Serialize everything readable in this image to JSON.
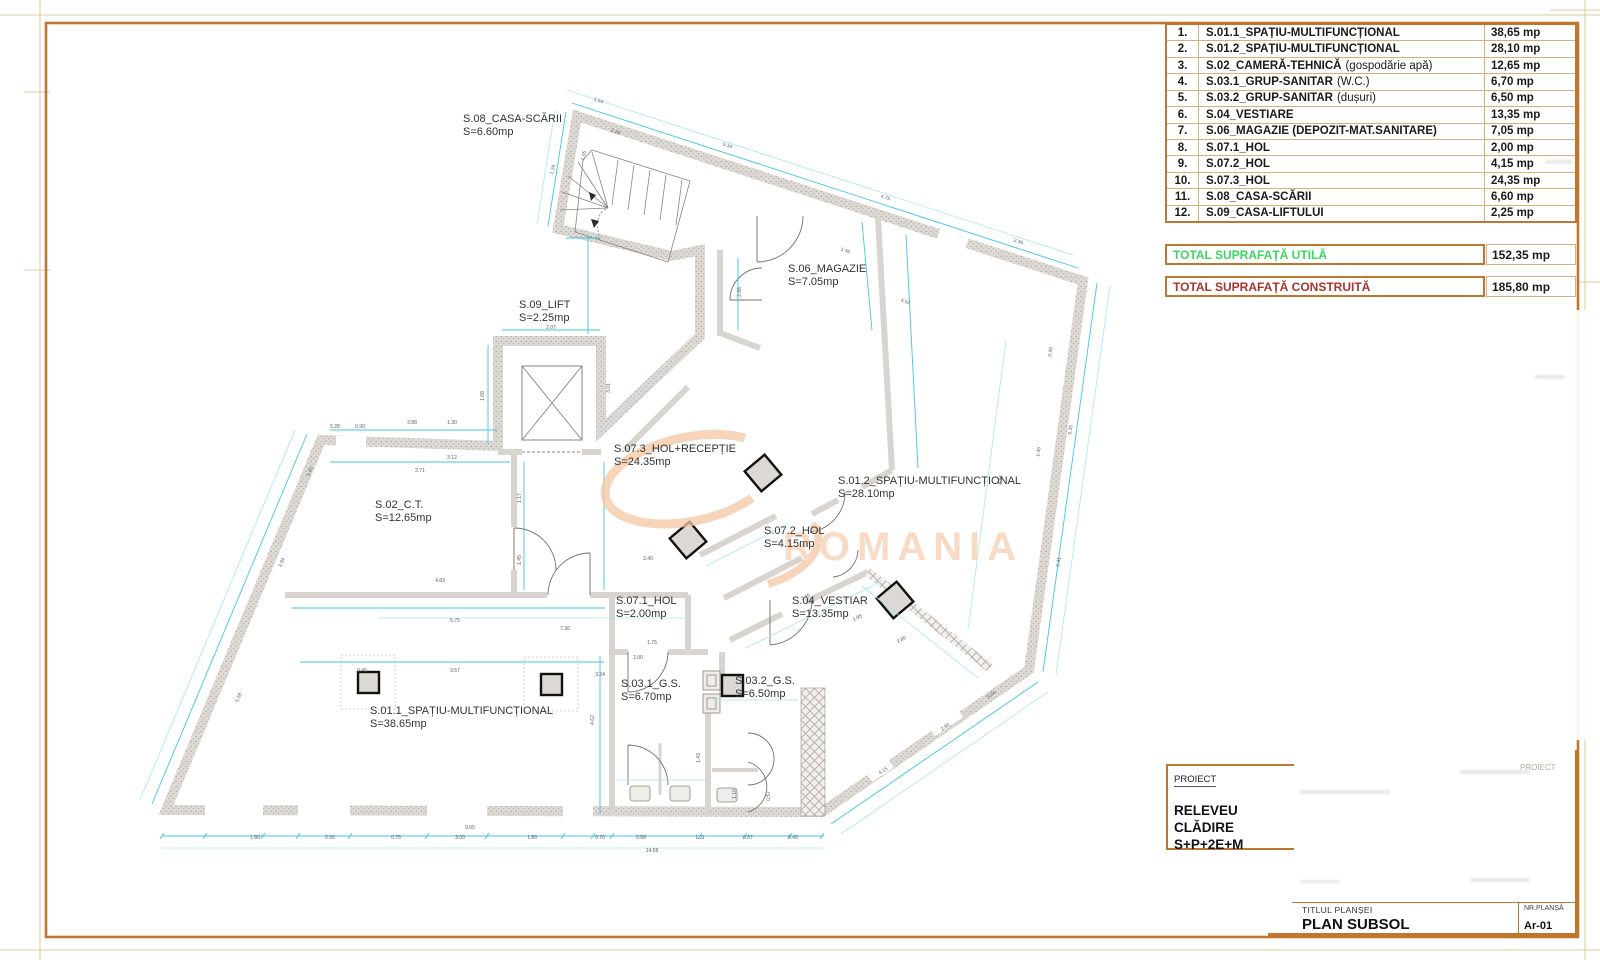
{
  "schedule": {
    "rows": [
      {
        "no": "1.",
        "label": "S.01.1_SPAȚIU-MULTIFUNCȚIONAL",
        "note": "",
        "area": "38,65 mp"
      },
      {
        "no": "2.",
        "label": "S.01.2_SPAȚIU-MULTIFUNCȚIONAL",
        "note": "",
        "area": "28,10 mp"
      },
      {
        "no": "3.",
        "label": "S.02_CAMERĂ-TEHNICĂ",
        "note": "(gospodărie apă)",
        "area": "12,65 mp"
      },
      {
        "no": "4.",
        "label": "S.03.1_GRUP-SANITAR",
        "note": "(W.C.)",
        "area": "6,70 mp"
      },
      {
        "no": "5.",
        "label": "S.03.2_GRUP-SANITAR",
        "note": "(dușuri)",
        "area": "6,50 mp"
      },
      {
        "no": "6.",
        "label": "S.04_VESTIARE",
        "note": "",
        "area": "13,35 mp"
      },
      {
        "no": "7.",
        "label": "S.06_MAGAZIE (DEPOZIT-MAT.SANITARE)",
        "note": "",
        "area": "7,05 mp"
      },
      {
        "no": "8.",
        "label": "S.07.1_HOL",
        "note": "",
        "area": "2,00 mp"
      },
      {
        "no": "9.",
        "label": "S.07.2_HOL",
        "note": "",
        "area": "4,15 mp"
      },
      {
        "no": "10.",
        "label": "S.07.3_HOL",
        "note": "",
        "area": "24,35 mp"
      },
      {
        "no": "11.",
        "label": "S.08_CASA-SCĂRII",
        "note": "",
        "area": "6,60 mp"
      },
      {
        "no": "12.",
        "label": "S.09_CASA-LIFTULUI",
        "note": "",
        "area": "2,25 mp"
      }
    ],
    "total_util": {
      "label": "TOTAL SUPRAFAȚĂ UTILĂ",
      "value": "152,35 mp",
      "color": "#3bd65e"
    },
    "total_construit": {
      "label": "TOTAL SUPRAFAȚĂ CONSTRUITĂ",
      "value": "185,80 mp",
      "color": "#a93429"
    }
  },
  "title_block": {
    "proiect_label": "PROIECT",
    "proiect_label_faded": "PROIECT",
    "project_name_line1": "RELEVEU CLĂDIRE",
    "project_name_line2": "S+P+2E+M",
    "titlul_plansei_label": "TITLUL PLANȘEI",
    "plan_title": "PLAN SUBSOL",
    "nr_plansa_label": "NR.PLANȘĂ",
    "nr_plansa_value": "Ar-01"
  },
  "plan": {
    "watermark_text": "ROMANIA",
    "colors": {
      "frame": "#c0762c",
      "grid": "#d9af7e",
      "dim_cyan": "#3fc6e4",
      "dim_cyan_light": "#a9e5f3",
      "wall_gray": "#dcd8d3",
      "watermark": "#f4c7a4"
    },
    "rooms": [
      {
        "id": "s08",
        "name": "S.08_CASA-SCĂRII",
        "area": "S=6.60mp",
        "x": 463,
        "y": 122
      },
      {
        "id": "s09",
        "name": "S.09_LIFT",
        "area": "S=2.25mp",
        "x": 519,
        "y": 308
      },
      {
        "id": "s06",
        "name": "S.06_MAGAZIE",
        "area": "S=7.05mp",
        "x": 788,
        "y": 272
      },
      {
        "id": "s073",
        "name": "S.07.3_HOL+RECEPȚIE",
        "area": "S=24.35mp",
        "x": 614,
        "y": 452
      },
      {
        "id": "s012",
        "name": "S.01.2_SPAȚIU-MULTIFUNCȚIONAL",
        "area": "S=28.10mp",
        "x": 838,
        "y": 484
      },
      {
        "id": "s02",
        "name": "S.02_C.T.",
        "area": "S=12.65mp",
        "x": 375,
        "y": 508
      },
      {
        "id": "s072",
        "name": "S.07.2_HOL",
        "area": "S=4.15mp",
        "x": 764,
        "y": 534
      },
      {
        "id": "s071",
        "name": "S.07.1_HOL",
        "area": "S=2.00mp",
        "x": 616,
        "y": 604
      },
      {
        "id": "s04",
        "name": "S.04_VESTIAR",
        "area": "S=13.35mp",
        "x": 792,
        "y": 604
      },
      {
        "id": "s031",
        "name": "S.03.1_G.S.",
        "area": "S=6.70mp",
        "x": 621,
        "y": 687
      },
      {
        "id": "s032",
        "name": "S.03.2_G.S.",
        "area": "S=6.50mp",
        "x": 735,
        "y": 684
      },
      {
        "id": "s011",
        "name": "S.01.1_SPAȚIU-MULTIFUNCȚIONAL",
        "area": "S=38.65mp",
        "x": 370,
        "y": 714
      }
    ],
    "dims": [
      {
        "t": "1.80",
        "x": 255,
        "y": 839,
        "r": 0
      },
      {
        "t": "0.90",
        "x": 330,
        "y": 839,
        "r": 0
      },
      {
        "t": "0.75",
        "x": 396,
        "y": 839,
        "r": 0
      },
      {
        "t": "3.00",
        "x": 460,
        "y": 839,
        "r": 0
      },
      {
        "t": "1.80",
        "x": 532,
        "y": 839,
        "r": 0
      },
      {
        "t": "0.70",
        "x": 600,
        "y": 839,
        "r": 0
      },
      {
        "t": "0.58",
        "x": 641,
        "y": 839,
        "r": 0
      },
      {
        "t": "1.11",
        "x": 700,
        "y": 839,
        "r": 0
      },
      {
        "t": "0.57",
        "x": 748,
        "y": 839,
        "r": 0
      },
      {
        "t": "0.40",
        "x": 793,
        "y": 839,
        "r": 0
      },
      {
        "t": "14.58",
        "x": 652,
        "y": 852,
        "r": 0
      },
      {
        "t": "9.05",
        "x": 470,
        "y": 829,
        "r": 0
      },
      {
        "t": "5.58",
        "x": 240,
        "y": 698,
        "r": -67
      },
      {
        "t": "3.04",
        "x": 283,
        "y": 563,
        "r": -67
      },
      {
        "t": "1.41",
        "x": 311,
        "y": 472,
        "r": -67
      },
      {
        "t": "1.54",
        "x": 598,
        "y": 102,
        "r": 18
      },
      {
        "t": "5.34",
        "x": 727,
        "y": 147,
        "r": 18
      },
      {
        "t": "4.75",
        "x": 885,
        "y": 199,
        "r": 18
      },
      {
        "t": "2.46",
        "x": 1018,
        "y": 243,
        "r": 18
      },
      {
        "t": "4.52",
        "x": 905,
        "y": 303,
        "r": 18
      },
      {
        "t": "0.99",
        "x": 1052,
        "y": 352,
        "r": -82
      },
      {
        "t": "5.35",
        "x": 1072,
        "y": 430,
        "r": -82
      },
      {
        "t": "1.46",
        "x": 1040,
        "y": 452,
        "r": -82
      },
      {
        "t": "6.41",
        "x": 1060,
        "y": 562,
        "r": -82
      },
      {
        "t": "8.91",
        "x": 1002,
        "y": 480,
        "r": -82
      },
      {
        "t": "2.90",
        "x": 946,
        "y": 728,
        "r": -34
      },
      {
        "t": "4.15",
        "x": 884,
        "y": 772,
        "r": -34
      },
      {
        "t": "3.04",
        "x": 992,
        "y": 696,
        "r": -34
      },
      {
        "t": "5.28",
        "x": 335,
        "y": 428,
        "r": 0
      },
      {
        "t": "0.90",
        "x": 360,
        "y": 428,
        "r": 0
      },
      {
        "t": "3.88",
        "x": 412,
        "y": 424,
        "r": 0
      },
      {
        "t": "1.30",
        "x": 452,
        "y": 424,
        "r": 0
      },
      {
        "t": "2.07",
        "x": 551,
        "y": 329,
        "r": 0
      },
      {
        "t": "1.68",
        "x": 484,
        "y": 396,
        "r": -90
      },
      {
        "t": "3.12",
        "x": 452,
        "y": 459,
        "r": 0
      },
      {
        "t": "2.71",
        "x": 420,
        "y": 472,
        "r": 0
      },
      {
        "t": "1.17",
        "x": 521,
        "y": 498,
        "r": -90
      },
      {
        "t": "1.45",
        "x": 521,
        "y": 560,
        "r": -90
      },
      {
        "t": "4.83",
        "x": 440,
        "y": 582,
        "r": 0
      },
      {
        "t": "5.75",
        "x": 455,
        "y": 622,
        "r": 0
      },
      {
        "t": "7.36",
        "x": 565,
        "y": 630,
        "r": 0
      },
      {
        "t": "3.57",
        "x": 455,
        "y": 672,
        "r": 0
      },
      {
        "t": "0.40",
        "x": 362,
        "y": 672,
        "r": 0
      },
      {
        "t": "3.24",
        "x": 600,
        "y": 676,
        "r": 0
      },
      {
        "t": "4.62",
        "x": 594,
        "y": 720,
        "r": -90
      },
      {
        "t": "1.75",
        "x": 652,
        "y": 644,
        "r": 0
      },
      {
        "t": "2.00",
        "x": 638,
        "y": 659,
        "r": 0
      },
      {
        "t": "1.10",
        "x": 736,
        "y": 794,
        "r": -90
      },
      {
        "t": "0.57",
        "x": 770,
        "y": 796,
        "r": -90
      },
      {
        "t": "1.43",
        "x": 700,
        "y": 758,
        "r": -90
      },
      {
        "t": "3.46",
        "x": 806,
        "y": 598,
        "r": -28
      },
      {
        "t": "2.86",
        "x": 902,
        "y": 641,
        "r": -28
      },
      {
        "t": "1.98",
        "x": 858,
        "y": 619,
        "r": -28
      },
      {
        "t": "2.86",
        "x": 741,
        "y": 292,
        "r": -90
      },
      {
        "t": "1.46",
        "x": 845,
        "y": 252,
        "r": 18
      },
      {
        "t": "1.24",
        "x": 554,
        "y": 170,
        "r": -75
      },
      {
        "t": "1.05",
        "x": 585,
        "y": 156,
        "r": -75
      },
      {
        "t": "2.28",
        "x": 615,
        "y": 133,
        "r": 18
      },
      {
        "t": "3.01",
        "x": 610,
        "y": 388,
        "r": -90
      },
      {
        "t": "2.40",
        "x": 648,
        "y": 560,
        "r": 0
      }
    ]
  }
}
